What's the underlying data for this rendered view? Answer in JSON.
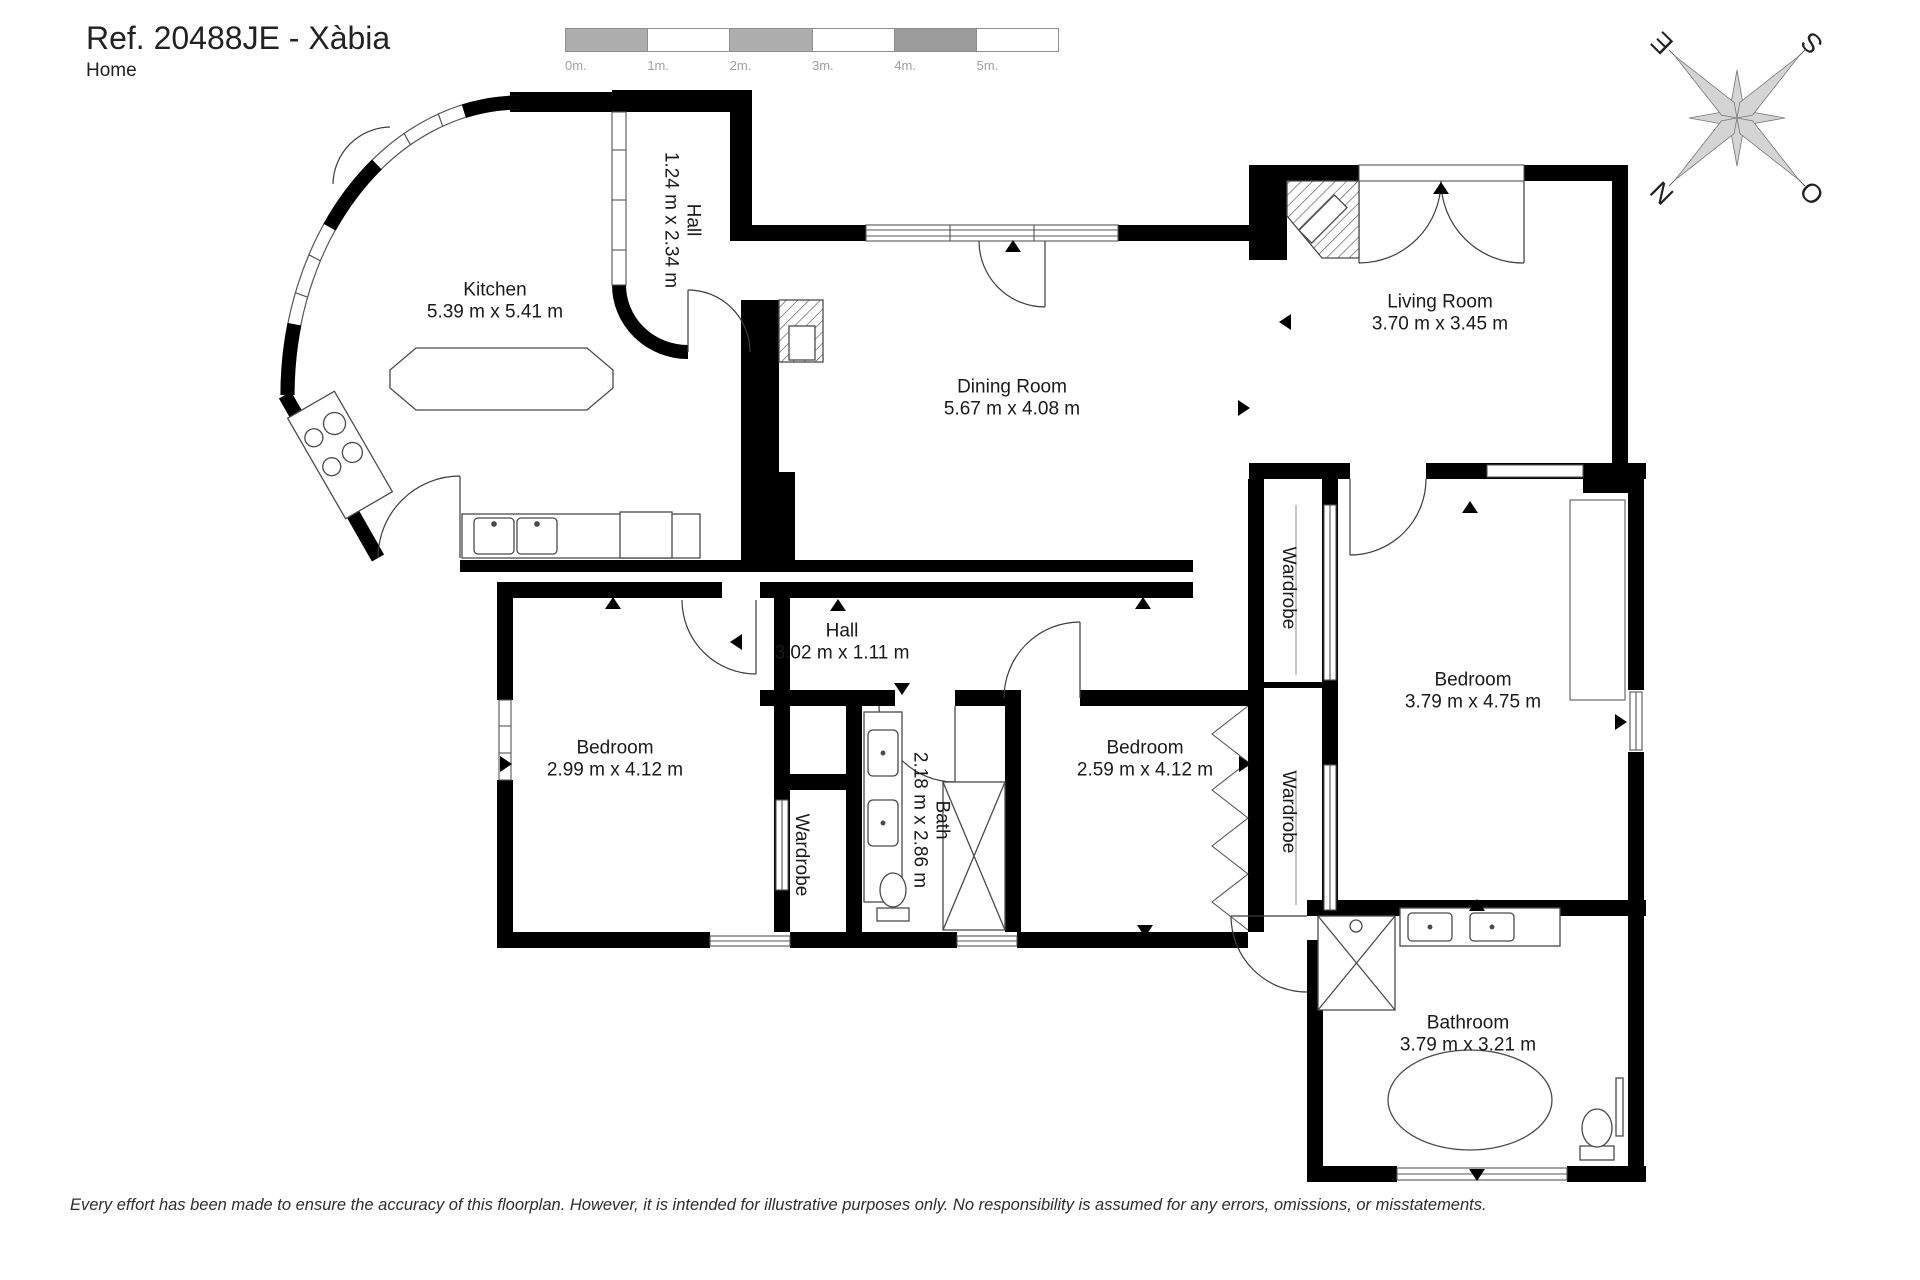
{
  "header": {
    "title": "Ref. 20488JE - Xàbia",
    "subtitle": "Home"
  },
  "scale_bar": {
    "labels": [
      "0m.",
      "1m.",
      "2m.",
      "3m.",
      "4m.",
      "5m."
    ]
  },
  "compass": {
    "north": "N",
    "south": "S",
    "east": "E",
    "west": "O"
  },
  "rooms": [
    {
      "name": "Kitchen",
      "dims": "5.39 m x 5.41 m",
      "x": 495,
      "y": 302,
      "vertical": false
    },
    {
      "name": "Hall",
      "dims": "1.24 m x 2.34 m",
      "x": 681,
      "y": 220,
      "vertical": true
    },
    {
      "name": "Dining Room",
      "dims": "5.67 m x 4.08 m",
      "x": 1012,
      "y": 399,
      "vertical": false
    },
    {
      "name": "Living Room",
      "dims": "3.70 m x 3.45 m",
      "x": 1440,
      "y": 314,
      "vertical": false
    },
    {
      "name": "Hall",
      "dims": "3.02 m x 1.11 m",
      "x": 842,
      "y": 643,
      "vertical": false
    },
    {
      "name": "Bedroom",
      "dims": "2.99 m x 4.12 m",
      "x": 615,
      "y": 760,
      "vertical": false
    },
    {
      "name": "Wardrobe",
      "dims": "",
      "x": 801,
      "y": 855,
      "vertical": true
    },
    {
      "name": "Bath",
      "dims": "2.18 m x 2.86 m",
      "x": 930,
      "y": 820,
      "vertical": true
    },
    {
      "name": "Bedroom",
      "dims": "2.59 m x 4.12 m",
      "x": 1145,
      "y": 760,
      "vertical": false
    },
    {
      "name": "Wardrobe",
      "dims": "",
      "x": 1288,
      "y": 588,
      "vertical": true
    },
    {
      "name": "Wardrobe",
      "dims": "",
      "x": 1288,
      "y": 812,
      "vertical": true
    },
    {
      "name": "Bedroom",
      "dims": "3.79 m x 4.75 m",
      "x": 1473,
      "y": 692,
      "vertical": false
    },
    {
      "name": "Bathroom",
      "dims": "3.79 m x 3.21 m",
      "x": 1468,
      "y": 1035,
      "vertical": false
    }
  ],
  "footer": {
    "disclaimer": "Every effort has been made to ensure the accuracy of this floorplan. However, it is intended for illustrative purposes only. No responsibility is assumed for any errors, omissions, or misstatements."
  },
  "colors": {
    "wall": "#000000",
    "scale_gray": "#adadad",
    "scale_gray_dark": "#9b9b9b",
    "compass_gray": "#d4d4d4"
  }
}
